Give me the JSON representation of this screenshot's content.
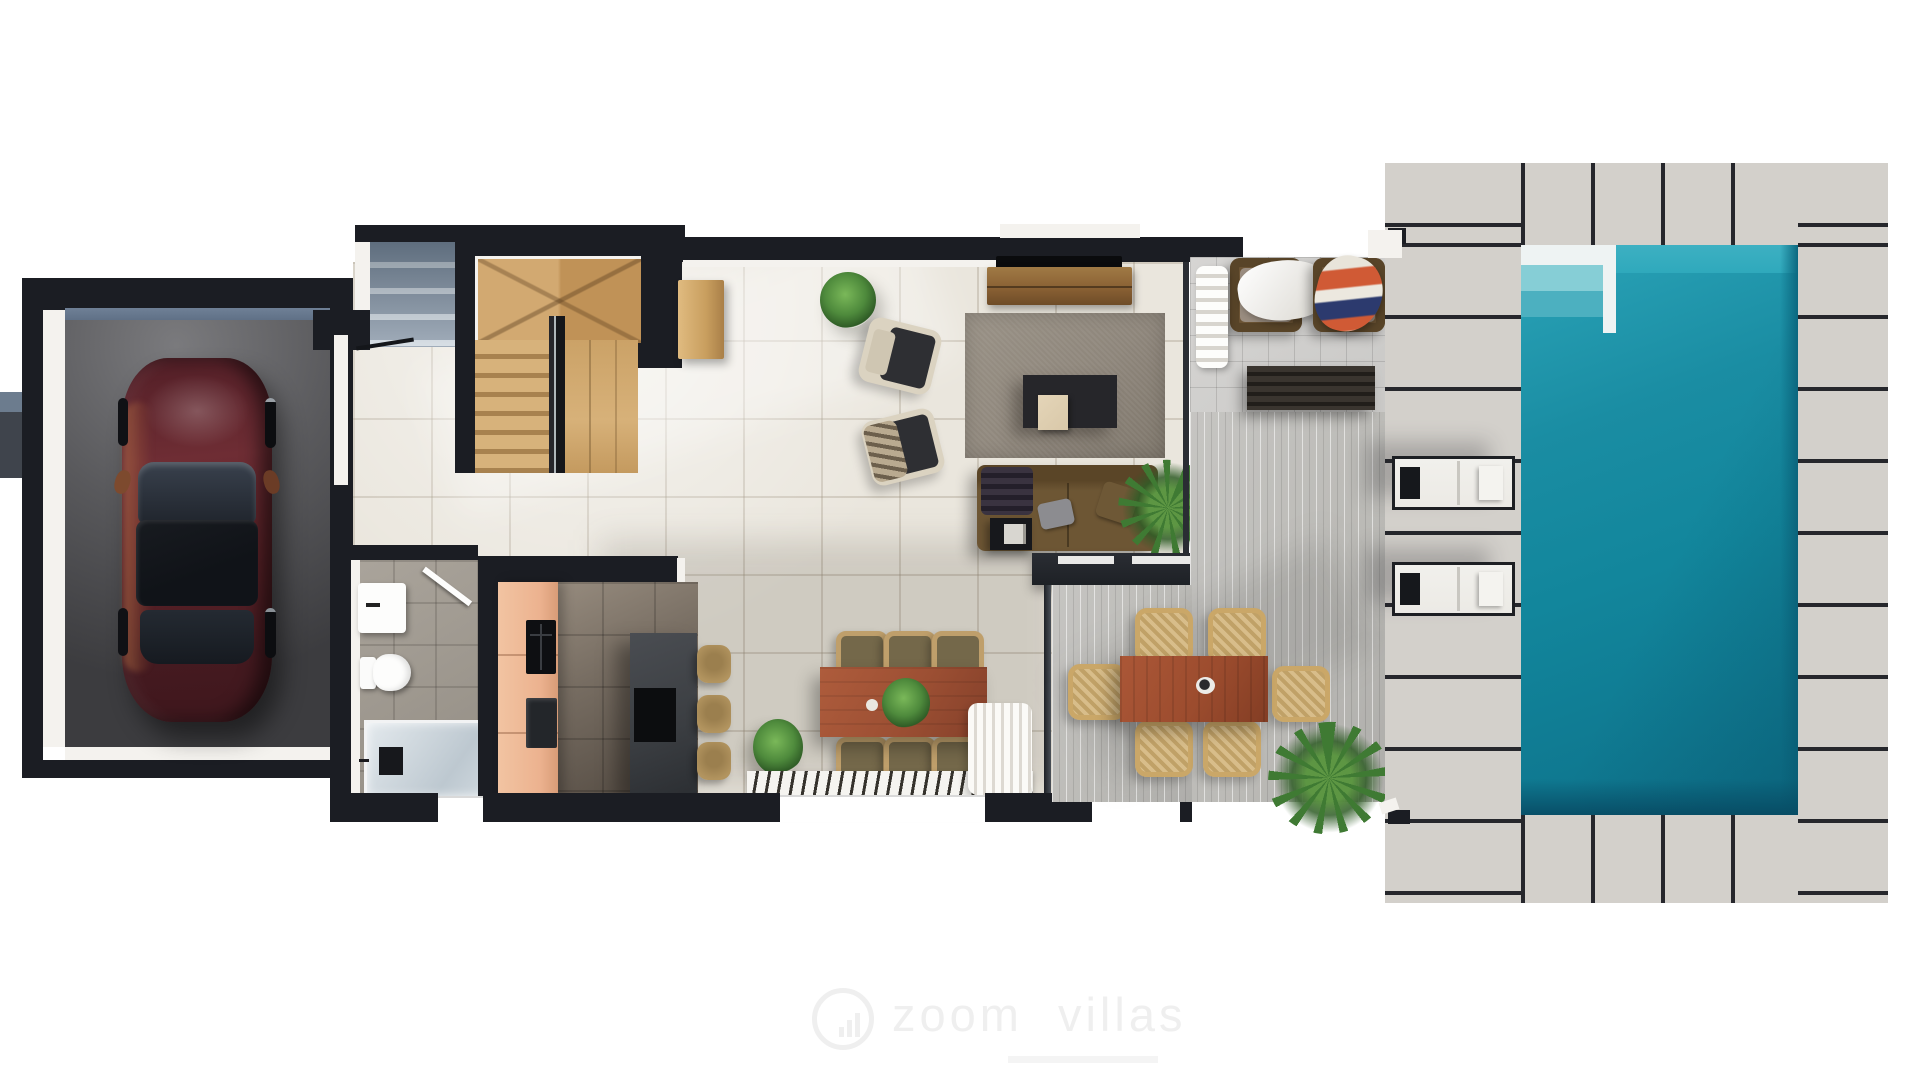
{
  "watermark": {
    "brand": "zoom villas",
    "icon": "bar-chart-circle-icon"
  },
  "scene": {
    "type": "villa-ground-floor-plan-render",
    "rooms_and_objects": [
      "garage",
      "car",
      "entrance-steps",
      "wooden-staircase",
      "hall-sideboard",
      "living-room",
      "tv",
      "tv-console",
      "area-rug",
      "coffee-table",
      "armchairs",
      "sofa",
      "side-table",
      "bathroom",
      "sink-vanity",
      "toilet",
      "shower",
      "kitchen",
      "kitchen-cabinets",
      "cooktop",
      "kitchen-island",
      "bar-stools",
      "dining-table",
      "dining-chairs",
      "runner-rug",
      "sheepskin-rug",
      "covered-porch",
      "porch-armchairs",
      "porch-slatted-table",
      "outdoor-dining-table",
      "outdoor-chairs",
      "striped-terrace",
      "pool-deck",
      "sun-loungers",
      "swimming-pool",
      "palm-plants",
      "potted-plants"
    ]
  },
  "palette": {
    "wall": "#1b1d23",
    "white-lining": "#f4f2ee",
    "floor": "#eae6dd",
    "bath-floor": "#a29c93",
    "kitchen-floor-a": "#958a7d",
    "kitchen-floor-b": "#584f46",
    "garage-floor-a": "#7a7a7d",
    "garage-floor-b": "#3c3c3f",
    "garage-door": "#5d6e84",
    "step-blue": "#8695a6",
    "stair-wood-a": "#d7b27b",
    "stair-wood-b": "#a8824f",
    "rail-dark": "#26262b",
    "sideboard-wood": "#c99f5f",
    "console-wood": "#8a6134",
    "tv-black": "#0a0b0d",
    "rug": "#8e867b",
    "coffee-table": "#26262a",
    "wood-cube": "#d9c8a9",
    "armchair-frame": "#dbd3c1",
    "armchair-seat": "#2e2f33",
    "sofa": "#6d5634",
    "throw-dark": "#3a3340",
    "pillow-gray": "#8c8c90",
    "pillow-brown": "#6e5836",
    "side-table": "#17181c",
    "half-wall": "#1e2126",
    "glass-dark": "#2a2d33",
    "salmon": "#ecb28f",
    "island": "#3b3e42",
    "stool-tan": "#b2945f",
    "dining-wood": "#9c4f33",
    "chair-frame-tan": "#bf9f6b",
    "chair-seat-olive": "#74684a",
    "outdoor-chair-tan": "#caa768",
    "outdoor-seat": "#d8bd8a",
    "porch-tile": "#cac9c7",
    "terrace-striped": "#bbbab6",
    "paver": "#d3d0cb",
    "paver-joint": "#26272c",
    "lounger-white": "#eceae5",
    "lounger-frame": "#1d1f23",
    "pool-rim": "#eef3f3",
    "pool-shallow": "#86ced6",
    "pool-mid": "#2fa9bc",
    "pool-water": "#12869c",
    "pool-deep": "#0a5a72",
    "plant": "#4e8a3c",
    "plant-dark": "#2f5c26",
    "palm": "#3f7a33",
    "car-body-a": "#6e2d34",
    "car-body-b": "#3f171d",
    "car-glass": "#1c2128",
    "car-copper": "#b06a40",
    "watermark": "#efefef"
  }
}
